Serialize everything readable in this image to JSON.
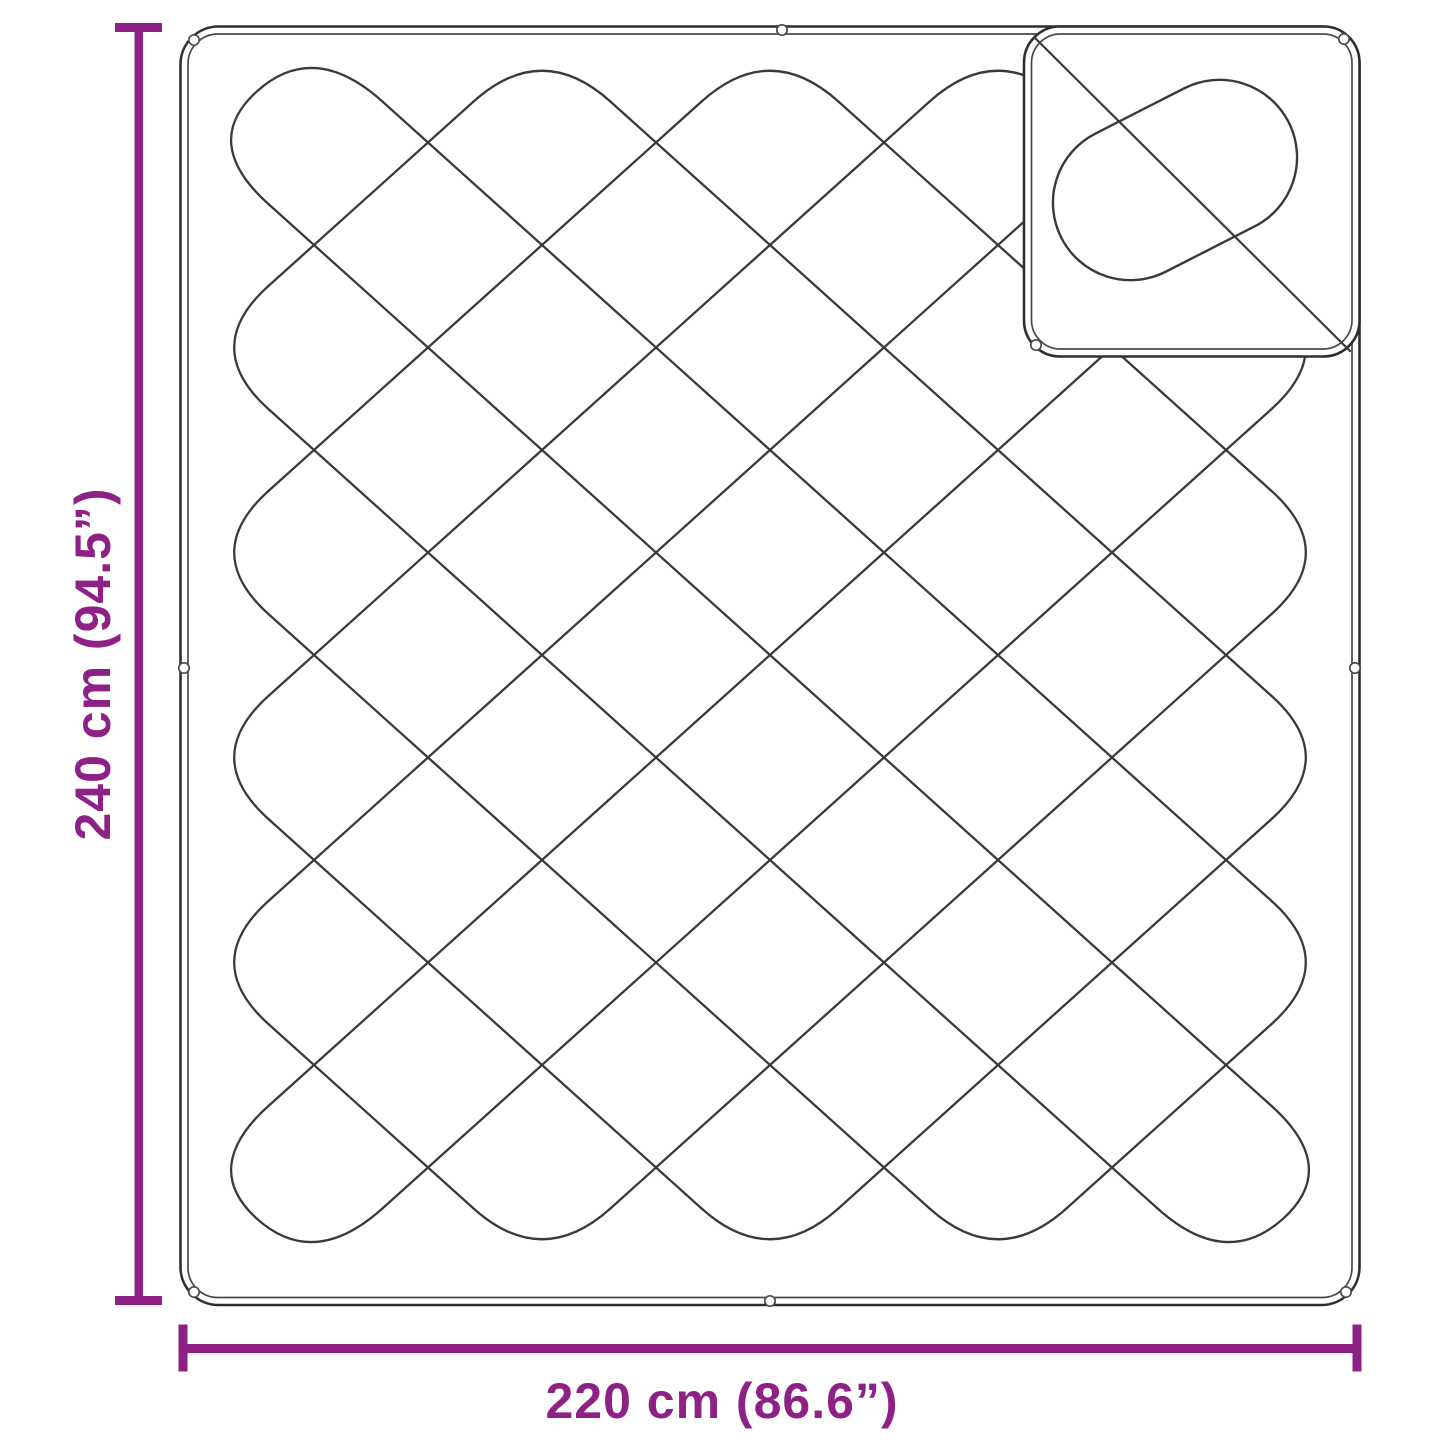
{
  "figure": {
    "type": "product-dimension-diagram"
  },
  "labels": {
    "height": "240 cm (94.5”)",
    "width": "220 cm (86.6”)"
  },
  "colors": {
    "accent": "#8E2186",
    "outline": "#3A3A3A",
    "border_outer": "#2F2F2F",
    "border_inner": "#4A4A4A",
    "background": "#FFFFFF"
  }
}
